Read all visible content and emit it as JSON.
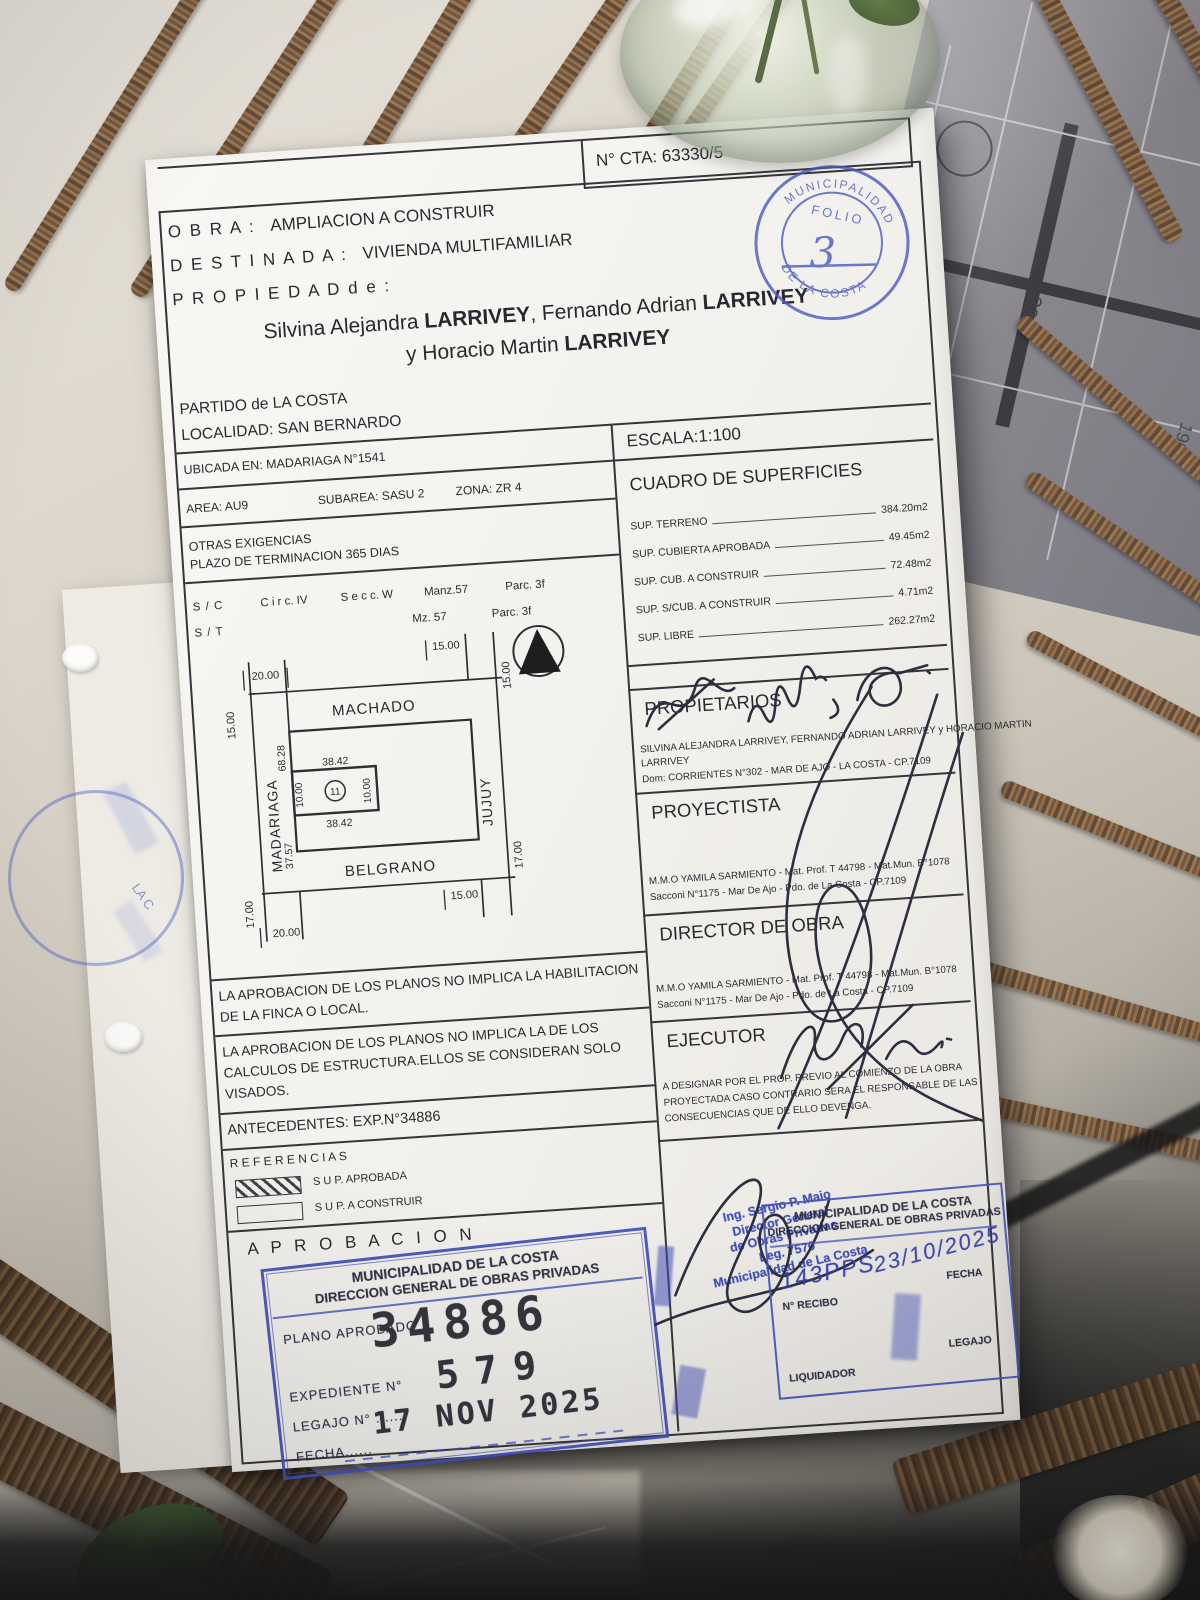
{
  "background": {
    "plan_numbers": {
      "n1": "250",
      "n2": "230",
      "n3": "190"
    }
  },
  "document": {
    "cta": "N° CTA: 63330/5",
    "header": {
      "obra_label": "O B R A :",
      "obra_value": "AMPLIACION A CONSTRUIR",
      "destinada_label": "D E S T I N A D A :",
      "destinada_value": "VIVIENDA MULTIFAMILIAR",
      "propiedad_label": "P R O P I E D A D   d e :"
    },
    "owners": {
      "g1": "Silvina Alejandra ",
      "s1": "LARRIVEY",
      "m1": ", Fernando Adrian ",
      "s2": "LARRIVEY",
      "g2": "y Horacio Martin ",
      "s3": "LARRIVEY"
    },
    "location": {
      "partido": "PARTIDO de LA COSTA",
      "localidad": "LOCALIDAD:  SAN BERNARDO",
      "ubicada": "UBICADA EN: MADARIAGA  N°1541",
      "area": "AREA: AU9",
      "subarea": "SUBAREA: SASU 2",
      "zona": "ZONA:  ZR 4",
      "otras": "OTRAS EXIGENCIAS",
      "plazo": "PLAZO DE TERMINACION 365 DIAS",
      "sc": "S / C",
      "circ": "C i r c.  IV",
      "secc": "S e c c. W",
      "manz": "Manz.57",
      "parc1": "Parc. 3f",
      "st": "S / T",
      "mz": "Mz. 57",
      "parc2": "Parc. 3f"
    },
    "escala": "ESCALA:1:100",
    "superficies": {
      "title": "CUADRO DE SUPERFICIES",
      "rows": [
        {
          "label": "SUP. TERRENO",
          "value": "384.20m2"
        },
        {
          "label": "SUP. CUBIERTA APROBADA",
          "value": "49.45m2"
        },
        {
          "label": "SUP. CUB. A CONSTRUIR",
          "value": "72.48m2"
        },
        {
          "label": "SUP. S/CUB. A CONSTRUIR",
          "value": "4.71m2"
        },
        {
          "label": "SUP. LIBRE",
          "value": "262.27m2"
        }
      ]
    },
    "map": {
      "streets": {
        "top": "MACHADO",
        "left": "MADARIAGA",
        "right": "JUJUY",
        "bottom": "BELGRANO"
      },
      "dims": {
        "tl": "20.00",
        "tr": "15.00",
        "left": "15.00",
        "right": "15.00",
        "bl": "17.00",
        "bottom": "20.00",
        "br": "15.00",
        "rb": "17.00",
        "block_upper": "68.28",
        "block_lower": "37.57",
        "parcel_top": "38.42",
        "parcel_bottom": "38.42",
        "parcel_left": "10.00",
        "parcel_right": "10.00",
        "parcel_no": "11"
      }
    },
    "sections": {
      "propietarios": {
        "title": "PROPIETARIOS",
        "l1": "SILVINA ALEJANDRA LARRIVEY, FERNANDO ADRIAN LARRIVEY y HORACIO MARTIN",
        "l2": "LARRIVEY",
        "l3": "Dom: CORRIENTES  N°302  -  MAR DE AJO  -  LA COSTA - CP.7109"
      },
      "proyectista": {
        "title": "PROYECTISTA",
        "l1": "M.M.O YAMILA SARMIENTO - Mat. Prof. T 44798 - Mat.Mun. B°1078",
        "l2": "Sacconi N°1175 - Mar De Ajo - Pdo. de La Costa - CP.7109"
      },
      "director": {
        "title": "DIRECTOR DE OBRA",
        "l1": "M.M.O YAMILA SARMIENTO - Mat. Prof. T 44798 - Mat.Mun. B°1078",
        "l2": "Sacconi N°1175 - Mar De Ajo - Pdo. de La Costa - CP.7109"
      },
      "ejecutor": {
        "title": "EJECUTOR",
        "l1": "A DESIGNAR POR EL PROP. PREVIO AL COMIENZO DE LA OBRA",
        "l2": "PROYECTADA CASO CONTRARIO SERA EL RESPONSABLE DE LAS",
        "l3": "CONSECUENCIAS QUE DE ELLO DEVENGA."
      }
    },
    "notes": {
      "n1a": "LA APROBACION DE LOS PLANOS NO IMPLICA LA HABILITACION",
      "n1b": "DE LA FINCA O LOCAL.",
      "n2a": "LA APROBACION DE LOS PLANOS NO IMPLICA LA DE LOS",
      "n2b": "CALCULOS DE ESTRUCTURA.ELLOS SE CONSIDERAN SOLO",
      "n2c": "VISADOS.",
      "antecedentes": "ANTECEDENTES: EXP.N°34886"
    },
    "referencias": {
      "title": "R E F E R E N C I A S",
      "i1": "S U P.  APROBADA",
      "i2": "S U P.  A CONSTRUIR"
    },
    "aprobacion_title": "A P R O B A C I O N",
    "stamps": {
      "approval": {
        "org": "MUNICIPALIDAD DE LA COSTA",
        "dept": "DIRECCION GENERAL DE OBRAS PRIVADAS",
        "plano_label": "PLANO APROBADO",
        "plano_number": "34886",
        "expediente_label": "EXPEDIENTE N°",
        "expediente_number": "579",
        "legajo_label": "LEGAJO N° .......",
        "fecha_label": "FECHA......",
        "fecha_value": "17 NOV 2025"
      },
      "receipt": {
        "org": "MUNICIPALIDAD DE LA COSTA",
        "dept": "DIRECCION GENERAL DE OBRAS PRIVADAS",
        "hw_recibo": "143PPS",
        "hw_fecha": "23/10/2025",
        "recibo_label": "N° RECIBO",
        "fecha_label": "FECHA",
        "liquidador_label": "LIQUIDADOR",
        "legajo_label": "LEGAJO"
      },
      "director_general": {
        "l1": "Ing. Sergio P. Maio",
        "l2": "Director General",
        "l3": "de Obras Privadas",
        "l4": "Leg. 7570",
        "l5": "Municipalidad de La Costa"
      },
      "folio": {
        "arc_top": "MUNICIPALIDAD",
        "arc_bottom": "DE LA COSTA",
        "label": "FOLIO",
        "number": "3"
      }
    },
    "colors": {
      "stamp_blue": "#3b4abb",
      "ink": "#1f2028"
    }
  }
}
